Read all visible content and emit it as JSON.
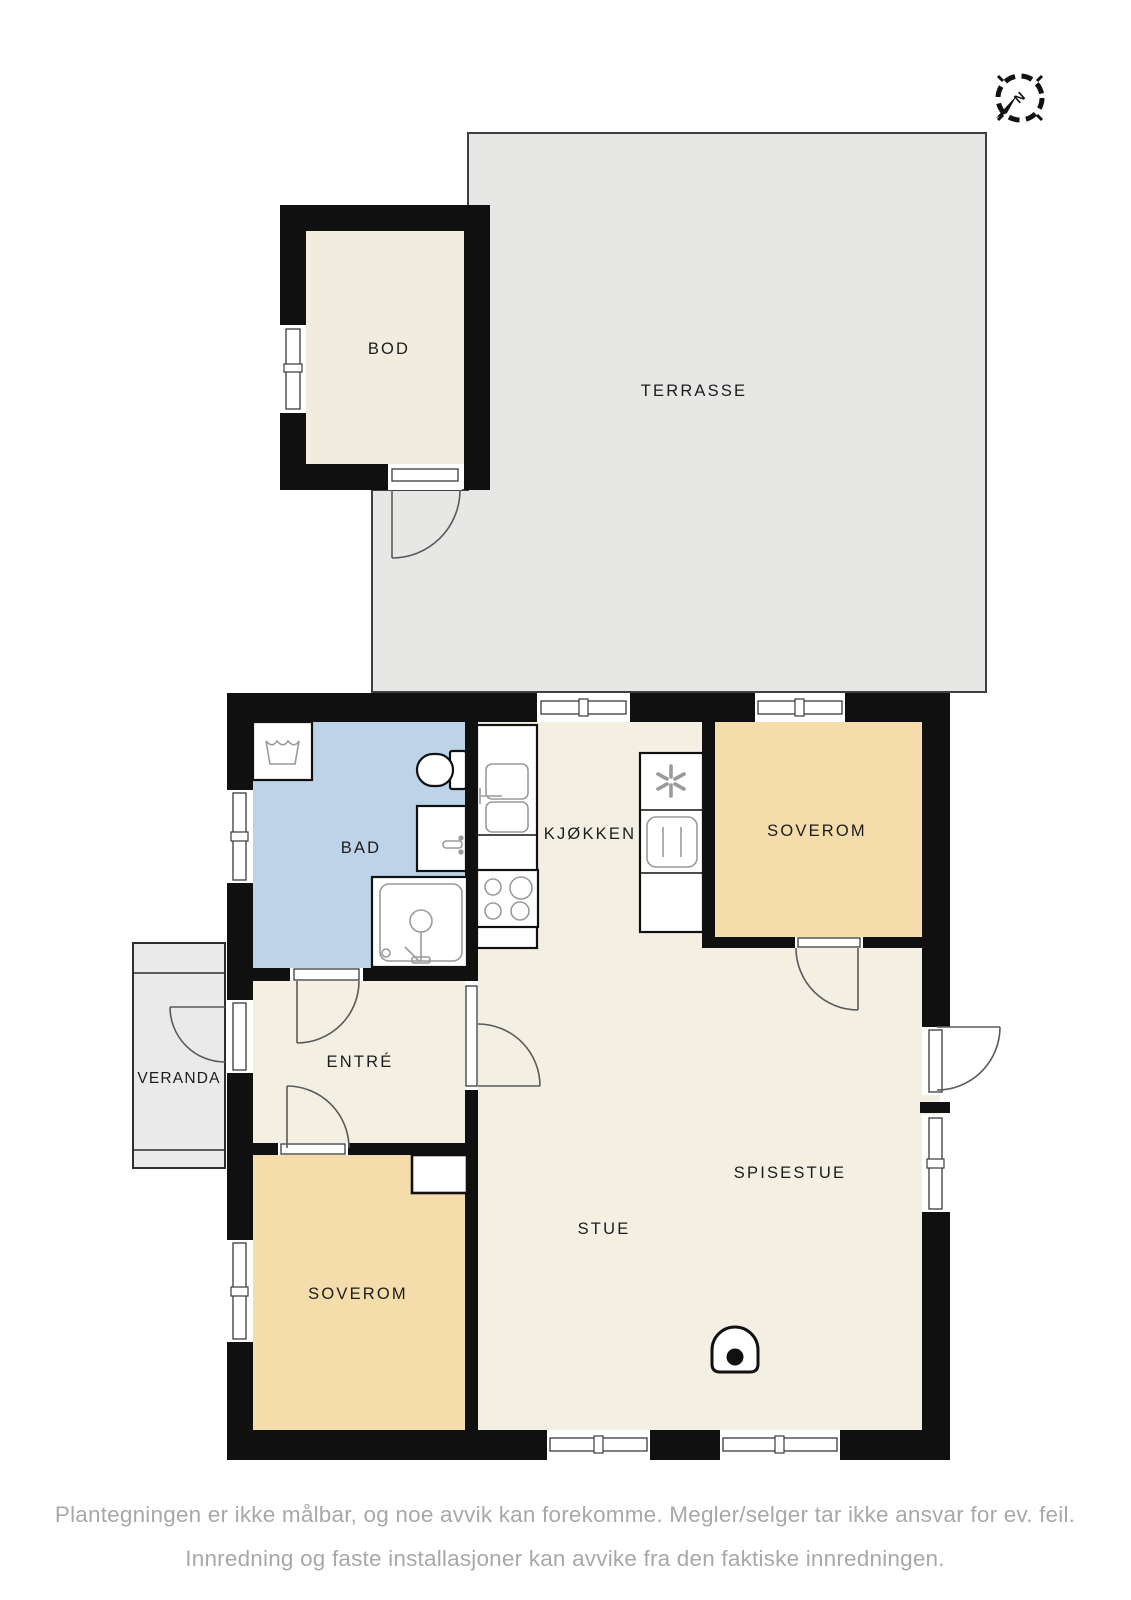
{
  "compass": {
    "north_label": "N"
  },
  "rooms": {
    "bod": {
      "label": "BOD"
    },
    "terrasse": {
      "label": "TERRASSE"
    },
    "bad": {
      "label": "BAD"
    },
    "kjokken": {
      "label": "KJØKKEN"
    },
    "soverom_ne": {
      "label": "SOVEROM"
    },
    "soverom_sw": {
      "label": "SOVEROM"
    },
    "entre": {
      "label": "ENTRÉ"
    },
    "veranda": {
      "label": "VERANDA"
    },
    "stue": {
      "label": "STUE"
    },
    "spisestue": {
      "label": "SPISESTUE"
    }
  },
  "disclaimer": {
    "line1": "Plantegningen er ikke målbar, og noe avvik kan forekomme. Megler/selger tar ikke ansvar for ev. feil.",
    "line2": "Innredning og faste installasjoner kan avvike fra den faktiske innredningen."
  },
  "colors": {
    "wall": "#101010",
    "floor": "#f4efe3",
    "storage_floor": "#f1ece0",
    "bedroom_floor": "#f5dcab",
    "bathroom_floor": "#bcd3e8",
    "terrace": "#e7e7e6",
    "veranda": "#eaeaea",
    "disclaimer_text": "#a8a8a8"
  }
}
